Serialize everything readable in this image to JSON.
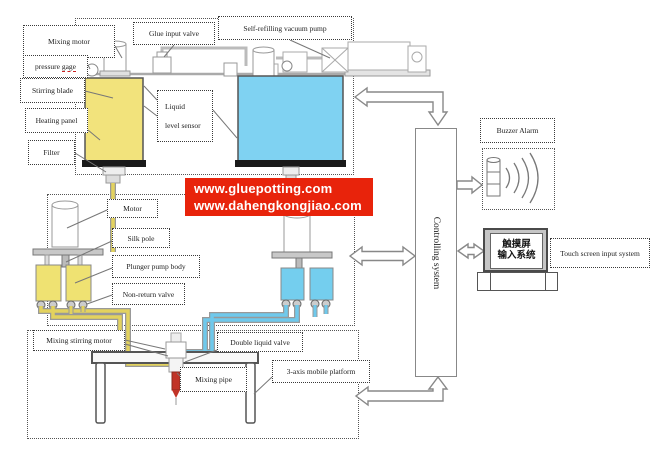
{
  "banner": {
    "lines": [
      "www.gluepotting.com",
      "www.dahengkongjiao.com"
    ]
  },
  "labels": {
    "mixing_motor": "Mixing motor",
    "glue_input_valve": "Glue input valve",
    "self_refilling_vacuum_pump": "Self-refilling vacuum pump",
    "pressure_gage_word1": "pressure",
    "pressure_gage_word2": "gage",
    "stirring_blade": "Stirring blade",
    "heating_panel": "Heating panel",
    "filter": "Filter",
    "liquid_line1": "Liquid",
    "liquid_line2": "level sensor",
    "motor": "Motor",
    "silk_pole": "Silk pole",
    "plunger_pump_body": "Plunger pump body",
    "non_return_valve": "Non-return valve",
    "mixing_stirring_motor": "Mixing stirring motor",
    "double_liquid_valve": "Double liquid valve",
    "mixing_pipe": "Mixing pipe",
    "three_axis_platform": "3-axis mobile platform",
    "controlling_system": "Controlling system",
    "buzzer_alarm": "Buzzer Alarm",
    "touch_screen_cn_line1": "触摸屏",
    "touch_screen_cn_line2": "输入系统",
    "touch_screen_input_system": "Touch screen input system"
  },
  "colors": {
    "banner_bg": "#E8230B",
    "tank_yellow": "#F2E37C",
    "tank_blue": "#7FD2F2",
    "pump_yellow": "#EFE272",
    "pump_blue": "#74CEEE",
    "pipe_yellow": "#E3D25E",
    "pipe_blue": "#6FC9EC",
    "mixing_pipe_red": "#C13327",
    "line_gray": "#8a8a8a"
  }
}
